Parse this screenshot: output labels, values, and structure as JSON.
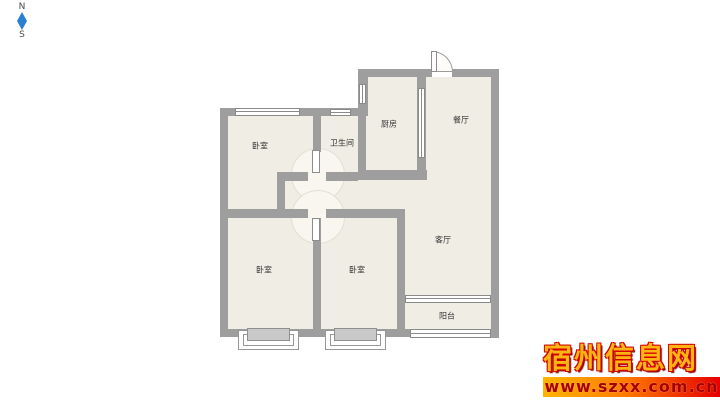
{
  "compass": {
    "north_label": "N",
    "south_label": "S"
  },
  "rooms": {
    "bedroom_nw": "卧室",
    "bathroom": "卫生间",
    "kitchen": "厨房",
    "dining": "餐厅",
    "living": "客厅",
    "bedroom_sw": "卧室",
    "bedroom_s": "卧室",
    "balcony": "阳台"
  },
  "watermark": {
    "site_name": "宿州信息网",
    "site_url": "www.szxx.com.cn"
  },
  "colors": {
    "wall": "#9e9e9e",
    "floor": "#f0eee4",
    "compass_blue": "#2a7fd0",
    "watermark_gold": "#ffb612",
    "watermark_outline_red": "#d40000",
    "url_band_start": "#ffb400",
    "url_band_end": "#e60000"
  }
}
